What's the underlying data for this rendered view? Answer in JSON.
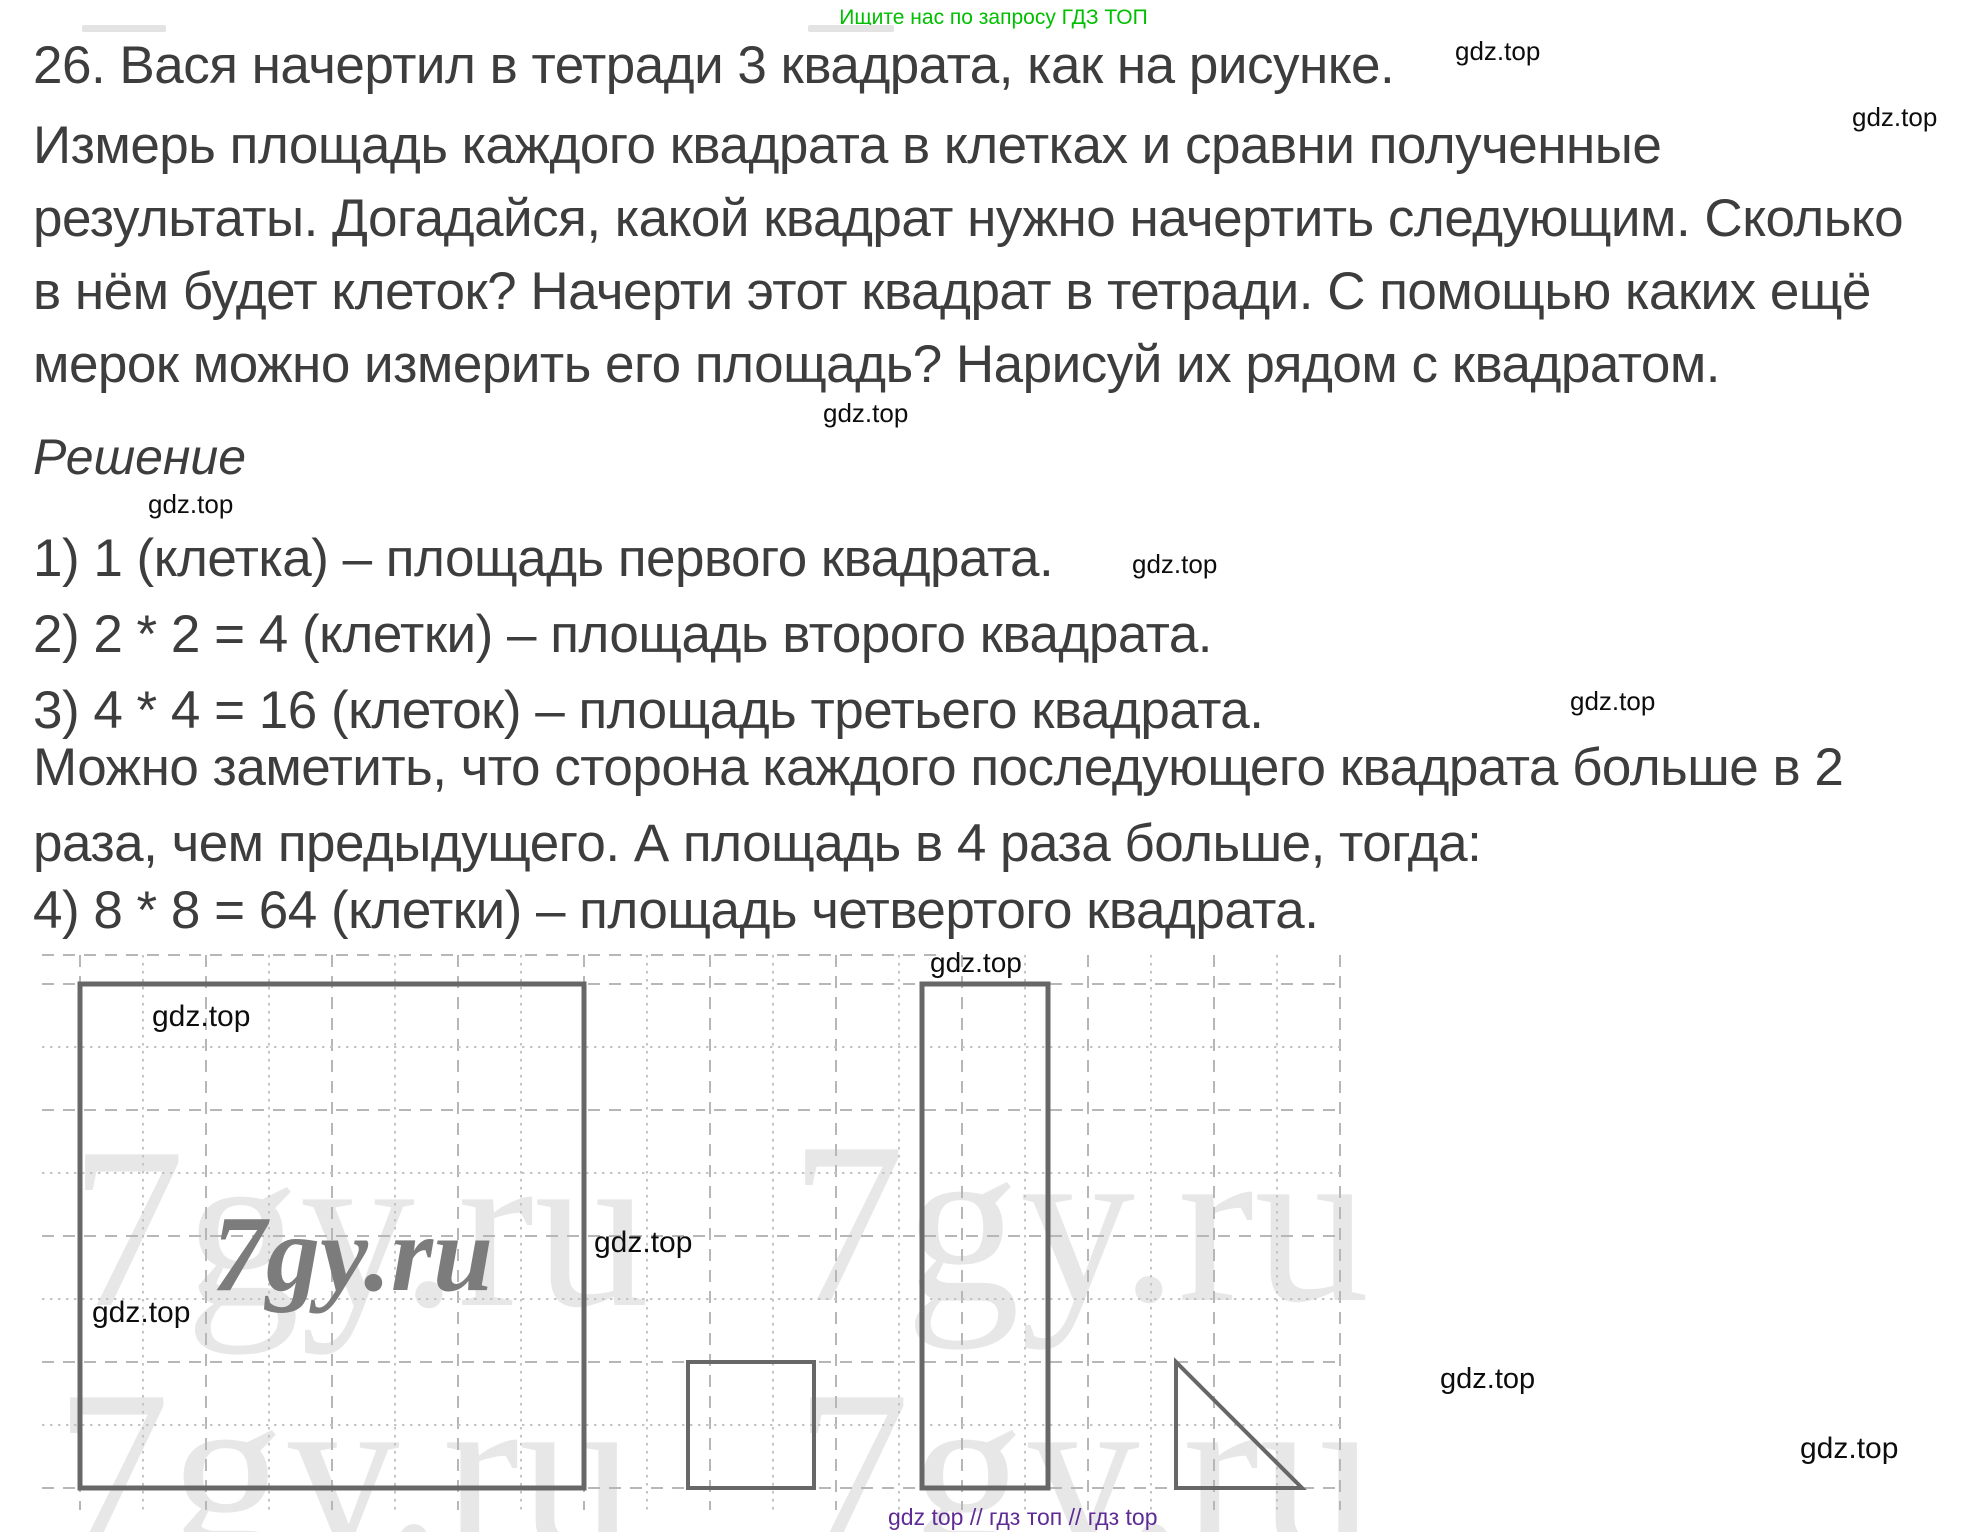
{
  "page": {
    "banner": "Ищите нас по запросу ГДЗ ТОП",
    "watermark": "gdz.top",
    "brand": "7gy.ru",
    "footer": "gdz top  //  гдз топ  //  гдз top"
  },
  "problem": {
    "number": "26",
    "lines": [
      "26. Вася начертил в тетради 3 квадрата, как на рисунке.",
      "Измерь площадь каждого квадрата в клетках и сравни полученные",
      "результаты. Догадайся, какой квадрат нужно начертить следующим. Сколько",
      "в нём будет клеток? Начерти этот квадрат в тетради. С помощью каких ещё",
      "мерок можно измерить его площадь? Нарисуй их рядом с квадратом."
    ]
  },
  "solution": {
    "heading": "Решение",
    "lines": [
      "1) 1 (клетка) – площадь первого квадрата.",
      "2) 2 * 2 = 4 (клетки) – площадь второго квадрата.",
      "3) 4 * 4 = 16 (клеток) – площадь третьего квадрата.",
      "Можно заметить, что сторона каждого последующего квадрата больше в 2",
      "раза, чем предыдущего. А площадь в 4 раза больше, тогда:",
      "4) 8 * 8 = 64 (клетки) – площадь четвертого квадрата."
    ]
  },
  "figure": {
    "shapes": [
      {
        "name": "fourth-square",
        "side_cells": 8
      },
      {
        "name": "measure-small-square",
        "side_cells": 2
      },
      {
        "name": "measure-strip",
        "width_cells": 2,
        "height_cells": 8
      },
      {
        "name": "measure-triangle",
        "leg_cells": 2
      }
    ]
  },
  "colors": {
    "banner_green": "#00bf00",
    "footer_purple": "#5e2c94",
    "body_text": "#3d3d3d",
    "shape_stroke": "#676767",
    "grid_line": "#bdbdbd",
    "light_watermark": "#e7e7e7",
    "dark_watermark": "#7c7c7c"
  }
}
